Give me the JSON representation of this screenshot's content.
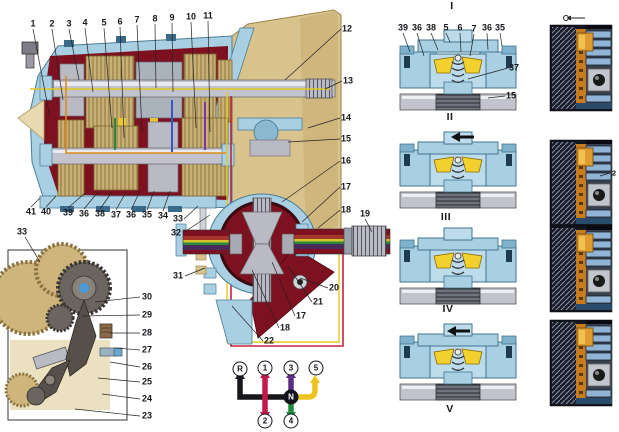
{
  "figure": {
    "kind": "gearbox-sectional-manual-illustration",
    "background": "#ffffff"
  },
  "palette": {
    "housing_blue": "#a9cfe2",
    "housing_blue_light": "#bcdcec",
    "case_maroon": "#7d1120",
    "bell_tan": "#d9c38c",
    "gear_tan": "#c9b176",
    "steel": "#c2c3cc",
    "blocker_yellow": "#f2d12e",
    "strip_dark": "#14161f",
    "strip_orange": "#c77d1f",
    "strip_bar_blue": "#8fb4d6"
  },
  "main_view": {
    "name": "gearbox-longitudinal-section",
    "callouts": [
      {
        "t": "1",
        "x": 33,
        "y": 24
      },
      {
        "t": "2",
        "x": 52,
        "y": 24
      },
      {
        "t": "3",
        "x": 69,
        "y": 24
      },
      {
        "t": "4",
        "x": 85,
        "y": 23
      },
      {
        "t": "5",
        "x": 104,
        "y": 23
      },
      {
        "t": "6",
        "x": 120,
        "y": 22
      },
      {
        "t": "7",
        "x": 137,
        "y": 20
      },
      {
        "t": "8",
        "x": 155,
        "y": 19
      },
      {
        "t": "9",
        "x": 172,
        "y": 18
      },
      {
        "t": "10",
        "x": 191,
        "y": 17
      },
      {
        "t": "11",
        "x": 208,
        "y": 16
      },
      {
        "t": "12",
        "x": 347,
        "y": 29
      },
      {
        "t": "13",
        "x": 348,
        "y": 81
      },
      {
        "t": "14",
        "x": 346,
        "y": 118
      },
      {
        "t": "15",
        "x": 346,
        "y": 139
      },
      {
        "t": "16",
        "x": 346,
        "y": 161
      },
      {
        "t": "17",
        "x": 346,
        "y": 187
      },
      {
        "t": "18",
        "x": 346,
        "y": 210
      },
      {
        "t": "19",
        "x": 365,
        "y": 214
      },
      {
        "t": "41",
        "x": 31,
        "y": 212
      },
      {
        "t": "40",
        "x": 46,
        "y": 212
      },
      {
        "t": "39",
        "x": 68,
        "y": 213
      },
      {
        "t": "36",
        "x": 84,
        "y": 214
      },
      {
        "t": "38",
        "x": 100,
        "y": 214
      },
      {
        "t": "37",
        "x": 116,
        "y": 215
      },
      {
        "t": "36",
        "x": 131,
        "y": 215
      },
      {
        "t": "35",
        "x": 147,
        "y": 215
      },
      {
        "t": "34",
        "x": 163,
        "y": 216
      },
      {
        "t": "33",
        "x": 178,
        "y": 219
      },
      {
        "t": "32",
        "x": 176,
        "y": 233
      },
      {
        "t": "31",
        "x": 178,
        "y": 276
      },
      {
        "t": "20",
        "x": 334,
        "y": 288
      },
      {
        "t": "21",
        "x": 318,
        "y": 302
      },
      {
        "t": "17",
        "x": 301,
        "y": 316
      },
      {
        "t": "18",
        "x": 285,
        "y": 328
      },
      {
        "t": "22",
        "x": 269,
        "y": 341
      }
    ]
  },
  "inset_view": {
    "name": "selector-mechanism-inset",
    "callouts": [
      {
        "t": "33",
        "x": 22,
        "y": 232
      },
      {
        "t": "30",
        "x": 147,
        "y": 297
      },
      {
        "t": "29",
        "x": 147,
        "y": 315
      },
      {
        "t": "28",
        "x": 147,
        "y": 333
      },
      {
        "t": "27",
        "x": 147,
        "y": 350
      },
      {
        "t": "26",
        "x": 147,
        "y": 367
      },
      {
        "t": "25",
        "x": 147,
        "y": 382
      },
      {
        "t": "24",
        "x": 147,
        "y": 399
      },
      {
        "t": "23",
        "x": 147,
        "y": 416
      }
    ]
  },
  "sync_stages": {
    "name": "synchronizer-operation-stages",
    "stages": [
      {
        "t": "I",
        "x": 452,
        "y": 6
      },
      {
        "t": "II",
        "x": 450,
        "y": 117
      },
      {
        "t": "III",
        "x": 446,
        "y": 217
      },
      {
        "t": "IV",
        "x": 448,
        "y": 309
      },
      {
        "t": "V",
        "x": 450,
        "y": 409
      }
    ],
    "callouts": [
      {
        "t": "39",
        "x": 403,
        "y": 28
      },
      {
        "t": "36",
        "x": 417,
        "y": 28
      },
      {
        "t": "38",
        "x": 431,
        "y": 28
      },
      {
        "t": "5",
        "x": 446,
        "y": 28
      },
      {
        "t": "6",
        "x": 460,
        "y": 28
      },
      {
        "t": "7",
        "x": 474,
        "y": 29
      },
      {
        "t": "36",
        "x": 487,
        "y": 28
      },
      {
        "t": "35",
        "x": 500,
        "y": 28
      },
      {
        "t": "37",
        "x": 514,
        "y": 68
      },
      {
        "t": "15",
        "x": 511,
        "y": 96
      }
    ]
  },
  "shift_pattern": {
    "name": "gear-shift-pattern",
    "positions": [
      {
        "t": "R",
        "x": 240,
        "y": 369
      },
      {
        "t": "1",
        "x": 265,
        "y": 368
      },
      {
        "t": "3",
        "x": 291,
        "y": 368
      },
      {
        "t": "5",
        "x": 316,
        "y": 368
      },
      {
        "t": "2",
        "x": 265,
        "y": 421
      },
      {
        "t": "4",
        "x": 291,
        "y": 421
      }
    ],
    "neutral": {
      "t": "N",
      "x": 291,
      "y": 397
    },
    "arrow_colors": {
      "reverse": "#17171c",
      "first_second": "#c2184a",
      "third": "#5c2d84",
      "fourth": "#1f8a3d",
      "fifth": "#eec41c"
    }
  },
  "detail_strip": {
    "name": "gear-engagement-detail-strip",
    "callouts": [
      {
        "t": "2",
        "x": 614,
        "y": 173
      }
    ]
  }
}
